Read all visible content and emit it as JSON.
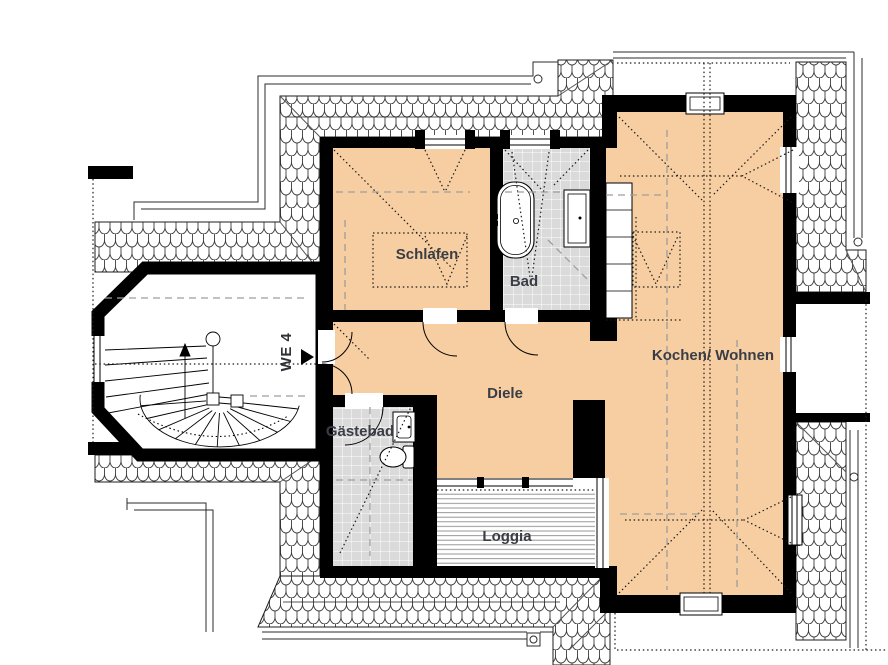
{
  "plan": {
    "title": "Floor plan apartment WE 4",
    "unit_label": "WE 4",
    "rooms": [
      {
        "id": "schlafen",
        "label": "Schlafen"
      },
      {
        "id": "bad",
        "label": "Bad"
      },
      {
        "id": "diele",
        "label": "Diele"
      },
      {
        "id": "kochen-wohnen",
        "label": "Kochen/ Wohnen"
      },
      {
        "id": "gaestebad",
        "label": "Gästebad"
      },
      {
        "id": "loggia",
        "label": "Loggia"
      }
    ],
    "fixtures": [
      "bathtub",
      "washbasin",
      "shower-cabinet",
      "kitchen-counter",
      "toilet",
      "hand-basin",
      "winding-staircase",
      "chimney",
      "roof-shingles",
      "gutter-downpipe"
    ],
    "colors": {
      "floor": "#F6CEA2",
      "tiles": "#DADADA",
      "walls": "#000000",
      "label_text": "#3A3D45",
      "dashed_guides": "#9E9E9E",
      "deck_lines": "#8C8C8C"
    }
  }
}
